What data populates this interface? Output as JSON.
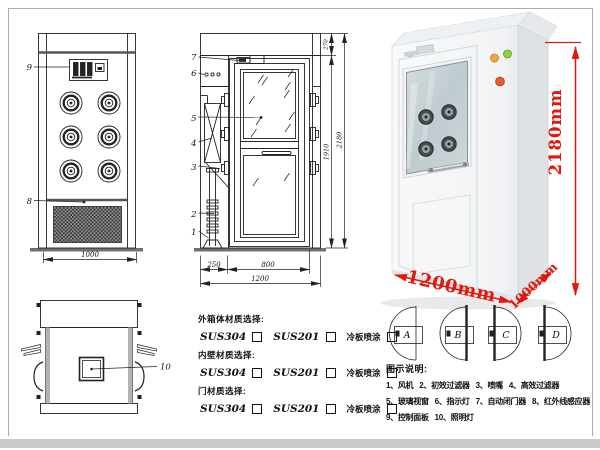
{
  "front_view": {
    "label_control_panel": "9",
    "label_grille": "8",
    "dim_width": "1000"
  },
  "side_view": {
    "labels": {
      "door_closer": "7",
      "indicator_lights": "6",
      "glass_window": "5",
      "filter": "4",
      "nozzle": "3",
      "pipe": "2",
      "base": "1"
    },
    "dims": {
      "left": "250",
      "door": "800",
      "total_width": "1200",
      "door_height": "1910",
      "total_height": "2180",
      "top_box": "270"
    }
  },
  "top_view": {
    "label_lamp": "10"
  },
  "door_options": [
    {
      "label": "A"
    },
    {
      "label": "B"
    },
    {
      "label": "C"
    },
    {
      "label": "D"
    }
  ],
  "photo": {
    "dim_height": "2180mm",
    "dim_width": "1200mm",
    "dim_depth": "1000mm"
  },
  "materials": {
    "groups": [
      {
        "title": "外箱体材质选择:",
        "options": [
          "SUS304",
          "SUS201",
          "冷板喷涂"
        ]
      },
      {
        "title": "内壁材质选择:",
        "options": [
          "SUS304",
          "SUS201",
          "冷板喷涂"
        ]
      },
      {
        "title": "门材质选择:",
        "options": [
          "SUS304",
          "SUS201",
          "冷板喷涂"
        ]
      }
    ]
  },
  "legend": {
    "title": "图示说明:",
    "items": [
      "1、风机",
      "2、初效过滤器",
      "3、喷嘴",
      "4、高效过滤器",
      "5、玻璃视窗",
      "6、指示灯",
      "7、自动闭门器",
      "8、红外线感应器",
      "9、控制面板",
      "10、照明灯"
    ]
  },
  "colors": {
    "dimension_red": "#e3170d",
    "line": "#222222",
    "frame": "#ababab"
  }
}
